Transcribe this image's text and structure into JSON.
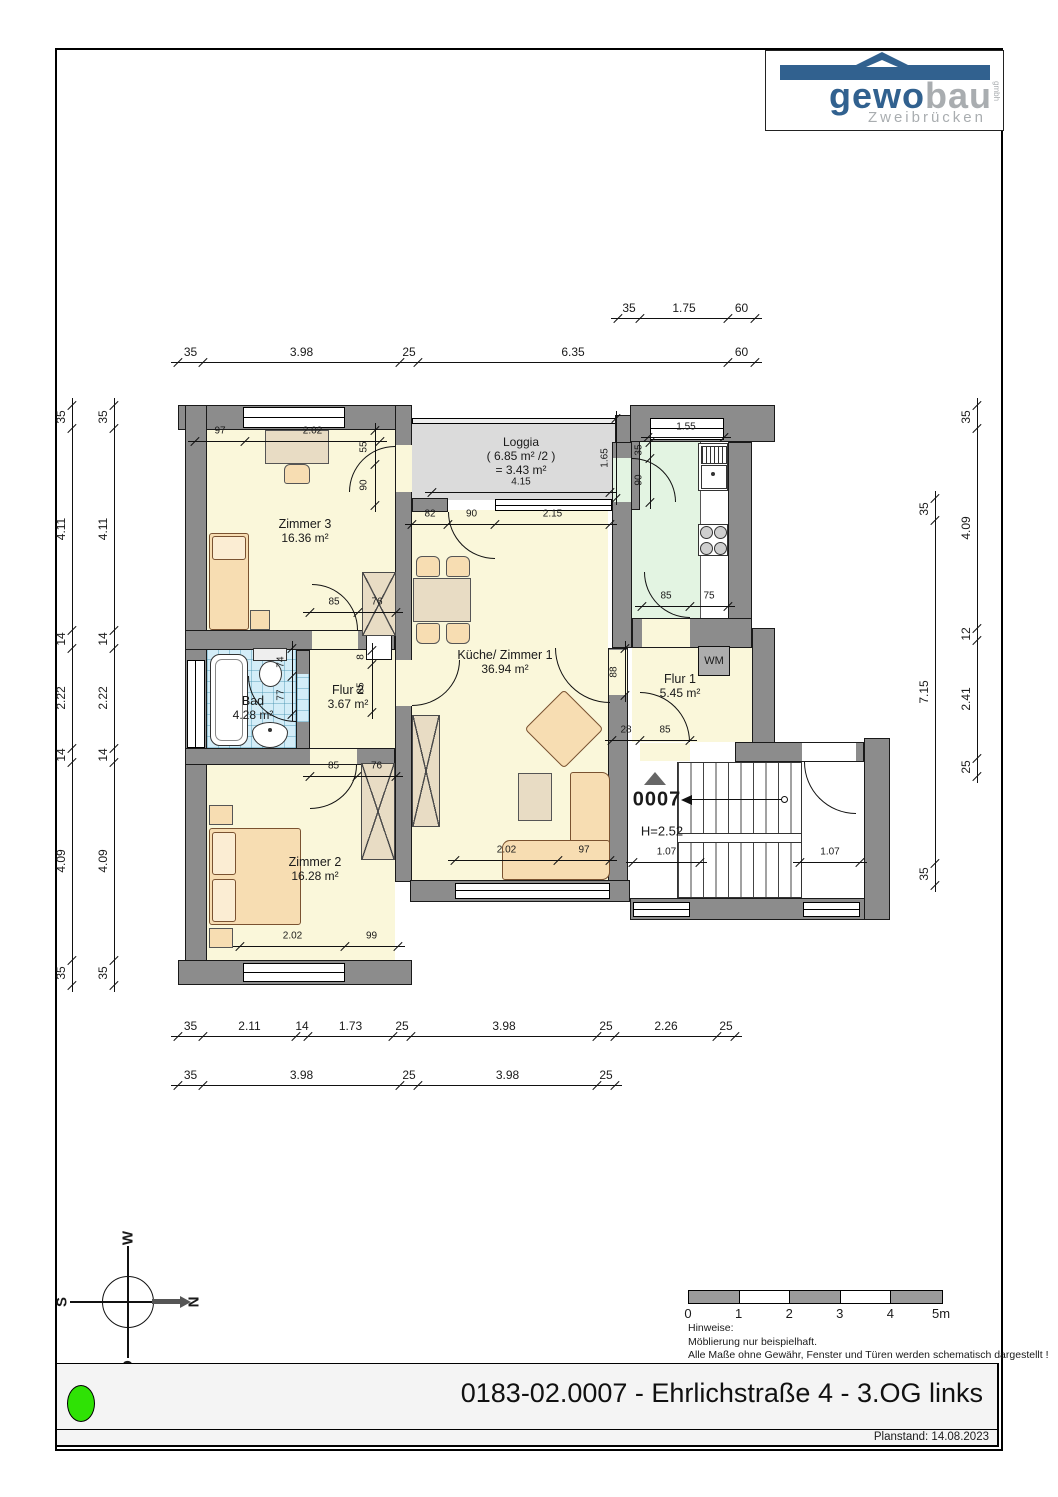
{
  "header": {
    "logo_main": "gewo",
    "logo_sub_word": "bau",
    "logo_gmbh": "gmbh",
    "logo_city": "Zweibrücken",
    "logo_color": "#31618F",
    "logo_gray": "#A9ADB0"
  },
  "rooms": {
    "zimmer3": {
      "name": "Zimmer 3",
      "area": "16.36 m²"
    },
    "zimmer2": {
      "name": "Zimmer 2",
      "area": "16.28 m²"
    },
    "kueche": {
      "name": "Küche/ Zimmer 1",
      "area": "36.94 m²"
    },
    "bad": {
      "name": "Bad",
      "area": "4.28 m²"
    },
    "flur1": {
      "name": "Flur 1",
      "area": "5.45 m²"
    },
    "flur2": {
      "name": "Flur 2",
      "area": "3.67 m²"
    },
    "loggia": {
      "name": "Loggia",
      "area_calc": "( 6.85 m² /2 )",
      "area": "= 3.43 m²"
    },
    "wm_label": "WM"
  },
  "stairwell": {
    "number": "0007",
    "height": "H=2.52"
  },
  "dims": {
    "top1": [
      "35",
      "1.75",
      "60"
    ],
    "top2": [
      "35",
      "3.98",
      "25",
      "6.35",
      "60"
    ],
    "bottom1": [
      "35",
      "2.11",
      "14",
      "1.73",
      "25",
      "3.98",
      "25",
      "2.26",
      "25"
    ],
    "bottom2": [
      "35",
      "3.98",
      "25",
      "3.98",
      "25"
    ],
    "left1": [
      "35",
      "4.11",
      "14",
      "2.22",
      "14",
      "4.09",
      "35"
    ],
    "left2": [
      "35",
      "4.11",
      "14",
      "2.22",
      "14",
      "4.09",
      "35"
    ],
    "right_inner": [
      "35",
      "7.15",
      "35"
    ],
    "right_outer": [
      "35",
      "4.09",
      "12",
      "2.41",
      "25"
    ],
    "z3_top": [
      "97",
      "2.02"
    ],
    "z3_right": [
      "55",
      "90"
    ],
    "z3_bottom": [
      "85",
      "76"
    ],
    "loggia_width": [
      "4.15"
    ],
    "loggia_depth": [
      "1.65"
    ],
    "below_loggia": [
      "82",
      "90",
      "2.15"
    ],
    "kitchen_window": [
      "1.55"
    ],
    "kitchen_door": [
      "35",
      "90"
    ],
    "kitchen_bottom": [
      "85",
      "75"
    ],
    "bad_fixture": [
      "74",
      "77"
    ],
    "flur2_door": [
      "8",
      "85"
    ],
    "kueche_flur1_door": [
      "88"
    ],
    "z2_top": [
      "85",
      "76"
    ],
    "z2_bottom": [
      "2.02",
      "99"
    ],
    "living_bottom": [
      "2.02",
      "97"
    ],
    "flur1_door": [
      "28",
      "85"
    ],
    "stairs_left": [
      "1.07"
    ],
    "stairs_right": [
      "1.07"
    ]
  },
  "compass": {
    "w": "W",
    "s": "S",
    "n": "N",
    "o": "O"
  },
  "scalebar": {
    "labels": [
      "0",
      "1",
      "2",
      "3",
      "4",
      "5m"
    ]
  },
  "notes": [
    "Hinweise:",
    "Möblierung nur beispielhaft.",
    "Alle Maße ohne Gewähr, Fenster und Türen werden schematisch dargestellt !"
  ],
  "footer": {
    "title": "0183-02.0007 - Ehrlichstraße 4 - 3.OG links",
    "planstand": "Planstand: 14.08.2023"
  },
  "colors": {
    "wall": "#8C8C8C",
    "room_yellow": "#FAF7DA",
    "kitchen_green": "#E3F4E2",
    "bath_blue": "#D3EDF8",
    "loggia_gray": "#DBDBDB",
    "status_dot_green": "#2FE205"
  }
}
